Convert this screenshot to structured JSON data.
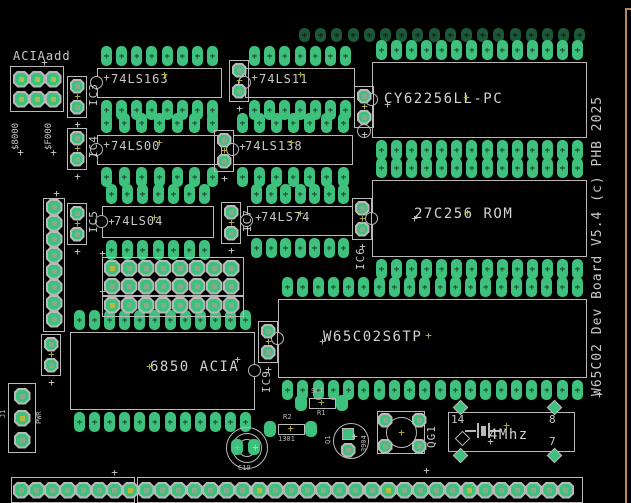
{
  "board": {
    "title_vertical": "W65C02 Dev Board V5.4 (c) PHB 2025"
  },
  "colors": {
    "background": "#000000",
    "pad_green": "#3ec17c",
    "silkscreen": "#b9b9b9",
    "label_gray": "#c9c9c9",
    "origin_yellow": "#b9b93d",
    "board_edge_tan": "#b5885c"
  },
  "ics": [
    {
      "id": "74ls163",
      "label": "74LS163",
      "pins": 16
    },
    {
      "id": "74ls11",
      "label": "74LS11",
      "pins": 14
    },
    {
      "id": "cy62256",
      "label": "CY62256LL-PC",
      "pins": 28
    },
    {
      "id": "74ls00",
      "label": "74LS00",
      "pins": 14
    },
    {
      "id": "74ls138",
      "label": "74LS138",
      "pins": 14
    },
    {
      "id": "74ls04",
      "label": "74LS04",
      "pins": 14
    },
    {
      "id": "74ls74",
      "label": "74LS74",
      "pins": 14
    },
    {
      "id": "27c256",
      "label": "27C256 ROM",
      "pins": 28
    },
    {
      "id": "w65c02",
      "label": "W65C02S6TP",
      "pins": 40
    },
    {
      "id": "6850",
      "label": "6850 ACIA",
      "pins": 24
    }
  ],
  "bypass_caps": [
    {
      "ref": "IC3"
    },
    {
      "ref": "IC4"
    },
    {
      "ref": "IC5"
    },
    {
      "ref": ""
    },
    {
      "ref": ""
    },
    {
      "ref": "IC7"
    },
    {
      "ref": ""
    },
    {
      "ref": "IC6"
    },
    {
      "ref": "IC9"
    },
    {
      "ref": ""
    }
  ],
  "jumper": {
    "label": "ACIAadd",
    "address_options": [
      "$8000",
      "$F000"
    ],
    "rows": 2,
    "cols": 3
  },
  "headers": {
    "left_pins": 8,
    "grid_rows": 3,
    "grid_cols": 8,
    "bottom_pins": 35,
    "top_pins": 18
  },
  "power_connector": {
    "ref": "J1",
    "label": "PWR",
    "pins": 3
  },
  "oscillator": {
    "ref": "QG1",
    "value": "4Mhz",
    "pin_numbers": [
      "14",
      "8",
      "7"
    ]
  },
  "discretes": {
    "c10_ref": "C10",
    "r1_ref": "R1",
    "r1_value": "SCT",
    "r2_ref": "R2",
    "r2_value": "1301",
    "q1_ref": "Q1",
    "q1_value": "3904"
  }
}
